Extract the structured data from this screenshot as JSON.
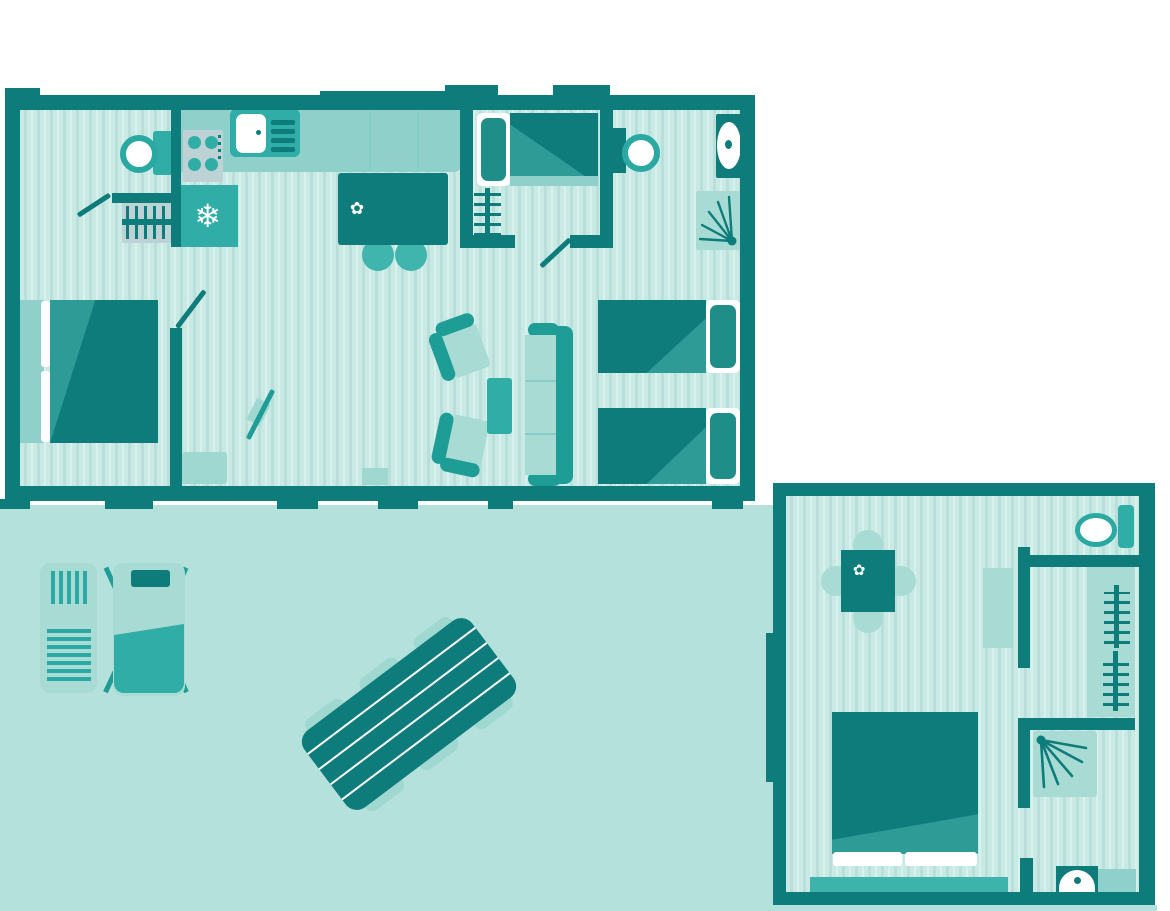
{
  "meta": {
    "description": "Flat teal architectural floor plan of a holiday mobile-home: one large unit, one annex unit and an outdoor terrace",
    "visible_text": "none"
  },
  "colors": {
    "dark": "#0e7c7b",
    "accent": "#1e9c96",
    "medium": "#2fada6",
    "counter": "#8fd1ca",
    "light": "#a8dbd4",
    "stool": "#3fb5ad",
    "mat": "#9fd8d1",
    "rug": "#3cb4ab",
    "pinner": "#1f8e89",
    "fold": "#2e9b96",
    "terrace": "#b4e1db",
    "floor_a": "#c9e9e4",
    "floor_b": "#badfda",
    "floor_c": "#d8f1ed",
    "panel": "#bdd2d4",
    "seam": "#86cfc7",
    "ring": "#2aa8a2",
    "white": "#ffffff"
  },
  "icons": {
    "snowflake": "❄",
    "flower": "✿"
  },
  "legend": {
    "outdoor": [
      "terrace",
      "sun-lounger-striped",
      "sun-lounger-cushion",
      "picnic-table-six-seats"
    ],
    "main_unit": [
      "double-bedroom",
      "kitchen-hob-sink-fridge-island",
      "living-area-sofa-armchairs-tv",
      "single-bedroom",
      "twin-bedroom",
      "bathroom-shower-toilet-basin"
    ],
    "annex_unit": [
      "dining-table-four-chairs",
      "toilet",
      "wardrobe-hanging-rails",
      "shower-room",
      "double-bedroom",
      "washbasin"
    ]
  }
}
